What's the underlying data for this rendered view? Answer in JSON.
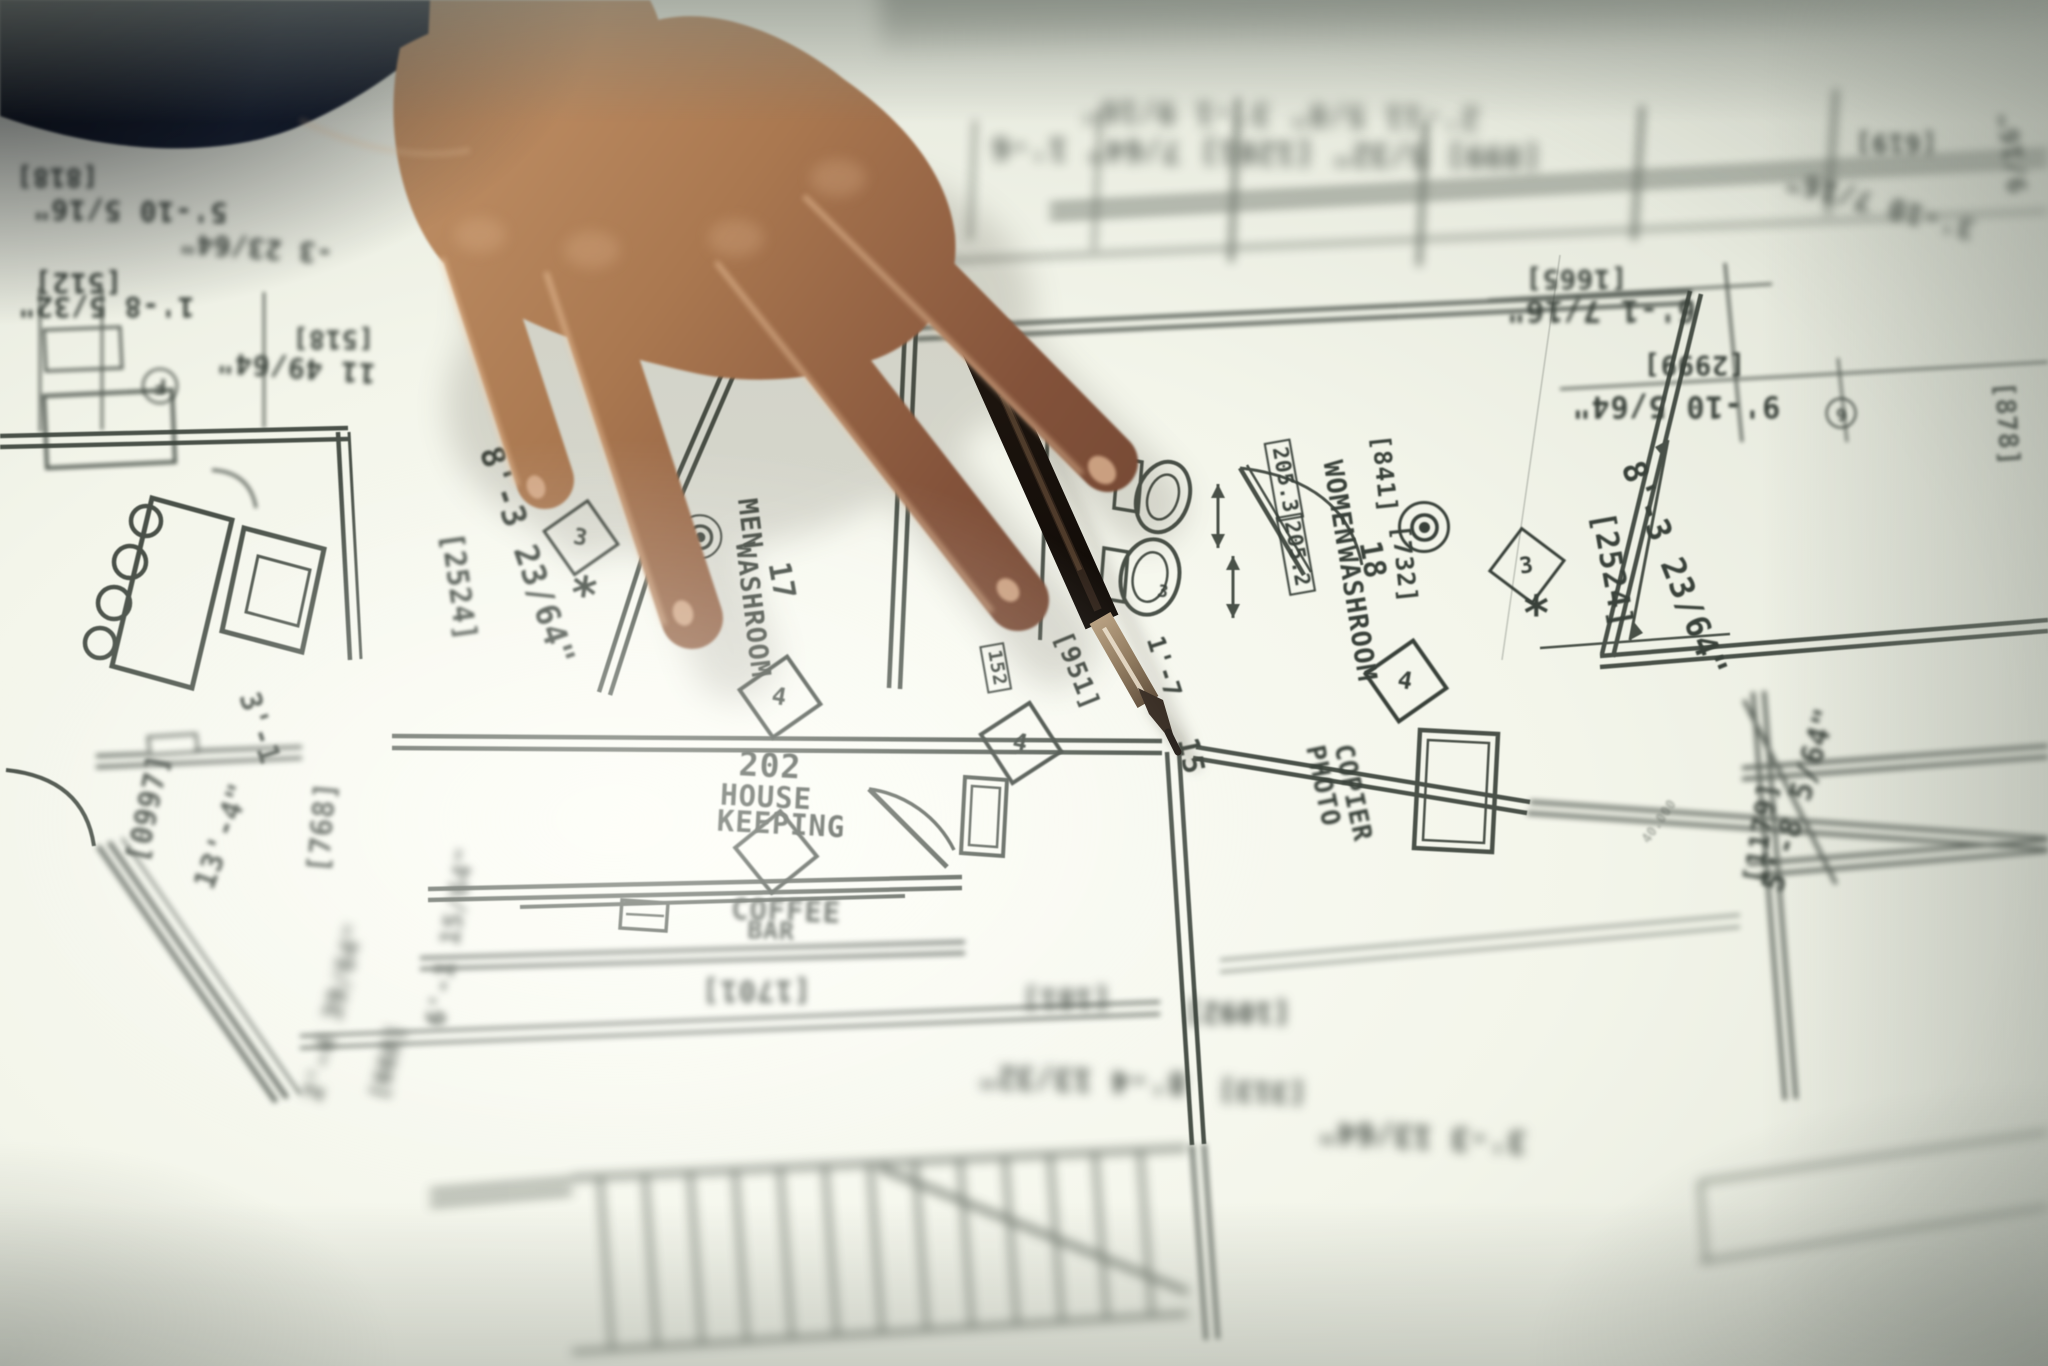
{
  "photo": {
    "palette": {
      "paper": "#f3f5ea",
      "paper_bright": "#fdfef8",
      "edge_shade": "#a9aea2",
      "ink_line": "#39413a",
      "sleeve_navy": "#141b2b",
      "skin": "#b2805a",
      "skin_shadow": "#6e4530",
      "skin_highlight": "#ecc29b",
      "pen_black": "#17110b",
      "pen_metal": "#a8906f"
    },
    "plan_labels": [
      {
        "t": "[818]",
        "x": 57,
        "y": 176,
        "r": 180,
        "s": 26,
        "b": 2.6
      },
      {
        "t": "5'-10 5/16\"",
        "x": 130,
        "y": 211,
        "r": 181,
        "s": 28,
        "b": 2.6
      },
      {
        "t": "-3 23/64\"",
        "x": 256,
        "y": 247,
        "r": 184,
        "s": 27,
        "b": 3.2
      },
      {
        "t": "[512]",
        "x": 78,
        "y": 283,
        "r": 180,
        "s": 28,
        "b": 2.2
      },
      {
        "t": "1'-8 5/32\"",
        "x": 106,
        "y": 307,
        "r": 180,
        "s": 28,
        "b": 2.2
      },
      {
        "t": "[518]",
        "x": 333,
        "y": 338,
        "r": 180,
        "s": 26,
        "b": 2.4
      },
      {
        "t": "11 49/64\"",
        "x": 296,
        "y": 368,
        "r": 184,
        "s": 28,
        "b": 2.4
      },
      {
        "t": "F",
        "x": 160,
        "y": 386,
        "r": 180,
        "s": 20,
        "b": 2.2,
        "shape": "circle"
      },
      {
        "t": "2'-11 5/8\"  3'-1 9/16\"",
        "x": 1280,
        "y": 114,
        "r": 181,
        "s": 30,
        "b": 6.5,
        "o": 0.8
      },
      {
        "t": "[899] 5/32\" [1201] 7/64\" 1'-6",
        "x": 1266,
        "y": 152,
        "r": 181,
        "s": 30,
        "b": 6,
        "o": 0.85
      },
      {
        "t": "[619]",
        "x": 1896,
        "y": 142,
        "r": 180,
        "s": 26,
        "b": 4
      },
      {
        "t": "3'-10 7/16\"",
        "x": 1880,
        "y": 205,
        "r": 195,
        "s": 28,
        "b": 4.5
      },
      {
        "t": "9/16\"",
        "x": 2014,
        "y": 152,
        "r": 262,
        "s": 26,
        "b": 4
      },
      {
        "t": "[1665]",
        "x": 1576,
        "y": 278,
        "r": 180,
        "s": 27,
        "b": 2
      },
      {
        "t": "6'-1 7/16\"",
        "x": 1601,
        "y": 310,
        "r": 180,
        "s": 30,
        "b": 2
      },
      {
        "t": "[2999]",
        "x": 1694,
        "y": 364,
        "r": 180,
        "s": 27,
        "b": 1.6
      },
      {
        "t": "9'-10 5/64\"",
        "x": 1676,
        "y": 406,
        "r": 180,
        "s": 30,
        "b": 1.6
      },
      {
        "t": "6",
        "x": 1841,
        "y": 413,
        "r": 170,
        "s": 17,
        "b": 1.8,
        "shape": "circle"
      },
      {
        "t": "[878]",
        "x": 2006,
        "y": 424,
        "r": 86,
        "s": 27,
        "b": 1.8
      },
      {
        "t": "[2524]",
        "x": 459,
        "y": 587,
        "r": 82,
        "s": 29,
        "b": 1.6
      },
      {
        "t": "8'-3 23/64\"",
        "x": 527,
        "y": 556,
        "r": 71,
        "s": 33,
        "b": 1.2
      },
      {
        "t": "3",
        "x": 581,
        "y": 538,
        "r": 10,
        "s": 28,
        "b": 1,
        "shape": "diamond"
      },
      {
        "t": "*",
        "x": 584,
        "y": 596,
        "r": 8,
        "s": 48,
        "b": 1
      },
      {
        "t": "MEN",
        "x": 749,
        "y": 524,
        "r": 83,
        "s": 27,
        "b": 0.8
      },
      {
        "t": "WASHROOM",
        "x": 752,
        "y": 610,
        "r": 83,
        "s": 27,
        "b": 0.8
      },
      {
        "t": "17",
        "x": 781,
        "y": 581,
        "r": 80,
        "s": 30,
        "b": 0.8
      },
      {
        "t": "",
        "x": 700,
        "y": 537,
        "r": 0,
        "s": 18,
        "b": 0.8,
        "shape": "target"
      },
      {
        "t": "4",
        "x": 780,
        "y": 697,
        "r": 10,
        "s": 30,
        "b": 0.7,
        "shape": "diamond"
      },
      {
        "t": "202",
        "x": 770,
        "y": 766,
        "r": 3,
        "s": 33,
        "b": 0.8
      },
      {
        "t": "HOUSE",
        "x": 766,
        "y": 797,
        "r": 3,
        "s": 29,
        "b": 0.8
      },
      {
        "t": "KEEPING",
        "x": 781,
        "y": 824,
        "r": 3,
        "s": 29,
        "b": 0.9
      },
      {
        "t": "",
        "x": 776,
        "y": 852,
        "r": 6,
        "s": 30,
        "b": 0.9,
        "shape": "diamond"
      },
      {
        "t": "COFFEE",
        "x": 786,
        "y": 911,
        "r": 2,
        "s": 29,
        "b": 2.4
      },
      {
        "t": "BAR",
        "x": 771,
        "y": 931,
        "r": 2,
        "s": 25,
        "b": 2.4
      },
      {
        "t": "[1701]",
        "x": 756,
        "y": 991,
        "r": 180,
        "s": 29,
        "b": 3.4
      },
      {
        "t": "[951]",
        "x": 1076,
        "y": 671,
        "r": 68,
        "s": 26,
        "b": 0.7
      },
      {
        "t": "152",
        "x": 996,
        "y": 668,
        "r": 80,
        "s": 19,
        "b": 0.7,
        "shape": "box"
      },
      {
        "t": "15",
        "x": 1191,
        "y": 756,
        "r": 78,
        "s": 29,
        "b": 0.7
      },
      {
        "t": "1'-7",
        "x": 1164,
        "y": 667,
        "r": 72,
        "s": 25,
        "b": 0.7
      },
      {
        "t": "4",
        "x": 1021,
        "y": 743,
        "r": 12,
        "s": 30,
        "b": 0.8,
        "shape": "diamond"
      },
      {
        "t": "3",
        "x": 1163,
        "y": 593,
        "r": 10,
        "s": 17,
        "b": 0.7
      },
      {
        "t": "205.3",
        "x": 1284,
        "y": 480,
        "r": 80,
        "s": 21,
        "b": 0.8,
        "shape": "box"
      },
      {
        "t": "205.2",
        "x": 1296,
        "y": 554,
        "r": 80,
        "s": 21,
        "b": 0.8,
        "shape": "box"
      },
      {
        "t": "WOMEN",
        "x": 1338,
        "y": 503,
        "r": 81,
        "s": 27,
        "b": 0.8
      },
      {
        "t": "WASHROOM",
        "x": 1356,
        "y": 614,
        "r": 81,
        "s": 27,
        "b": 0.8
      },
      {
        "t": "18",
        "x": 1372,
        "y": 560,
        "r": 80,
        "s": 30,
        "b": 0.8
      },
      {
        "t": "[841]",
        "x": 1384,
        "y": 474,
        "r": 84,
        "s": 25,
        "b": 0.8
      },
      {
        "t": "[732]",
        "x": 1404,
        "y": 564,
        "r": 84,
        "s": 25,
        "b": 0.8
      },
      {
        "t": "",
        "x": 1424,
        "y": 527,
        "r": 0,
        "s": 20,
        "b": 0.8,
        "shape": "target"
      },
      {
        "t": "4",
        "x": 1406,
        "y": 681,
        "r": 10,
        "s": 30,
        "b": 0.8,
        "shape": "diamond"
      },
      {
        "t": "PHOTO",
        "x": 1322,
        "y": 786,
        "r": 78,
        "s": 26,
        "b": 1.4
      },
      {
        "t": "COPIER",
        "x": 1352,
        "y": 793,
        "r": 78,
        "s": 26,
        "b": 1.4
      },
      {
        "t": "[2524]",
        "x": 1612,
        "y": 570,
        "r": 80,
        "s": 31,
        "b": 0.9
      },
      {
        "t": "8'-3 23/64\"",
        "x": 1674,
        "y": 569,
        "r": 68,
        "s": 33,
        "b": 0.9
      },
      {
        "t": "3",
        "x": 1527,
        "y": 566,
        "r": -8,
        "s": 28,
        "b": 0.8,
        "shape": "diamond"
      },
      {
        "t": "*",
        "x": 1537,
        "y": 615,
        "r": 0,
        "s": 48,
        "b": 0.8
      },
      {
        "t": "5'-8 5/64\"",
        "x": 1800,
        "y": 800,
        "r": -73,
        "s": 30,
        "b": 2.4
      },
      {
        "t": "[1179]",
        "x": 1762,
        "y": 833,
        "r": -81,
        "s": 27,
        "b": 2.4
      },
      {
        "t": "40.000",
        "x": 1660,
        "y": 822,
        "r": -55,
        "s": 13,
        "b": 1.2,
        "o": 0.4
      },
      {
        "t": "3'-1",
        "x": 260,
        "y": 728,
        "r": 72,
        "s": 29,
        "b": 1.6
      },
      {
        "t": "[0997]",
        "x": 148,
        "y": 808,
        "r": -78,
        "s": 29,
        "b": 2
      },
      {
        "t": "13'-4\"",
        "x": 222,
        "y": 836,
        "r": -70,
        "s": 29,
        "b": 2.2
      },
      {
        "t": "[768]",
        "x": 322,
        "y": 827,
        "r": -85,
        "s": 29,
        "b": 2
      },
      {
        "t": "6'-1 15/64\"",
        "x": 452,
        "y": 937,
        "r": -80,
        "s": 26,
        "b": 4
      },
      {
        "t": "2'-4 39/64\"",
        "x": 335,
        "y": 1012,
        "r": -76,
        "s": 26,
        "b": 5
      },
      {
        "t": "[668]",
        "x": 388,
        "y": 1062,
        "r": -76,
        "s": 24,
        "b": 5
      },
      {
        "t": "[181]",
        "x": 1066,
        "y": 999,
        "r": 180,
        "s": 28,
        "b": 5
      },
      {
        "t": "[1092]",
        "x": 1237,
        "y": 1013,
        "r": 180,
        "s": 28,
        "b": 5
      },
      {
        "t": "8'-4 13/32\"",
        "x": 1082,
        "y": 1079,
        "r": 182,
        "s": 30,
        "b": 5.5
      },
      {
        "t": "[313]",
        "x": 1262,
        "y": 1092,
        "r": 182,
        "s": 28,
        "b": 5.5
      },
      {
        "t": "3'-3 13/64\"",
        "x": 1422,
        "y": 1136,
        "r": 183,
        "s": 30,
        "b": 5.5
      }
    ]
  }
}
